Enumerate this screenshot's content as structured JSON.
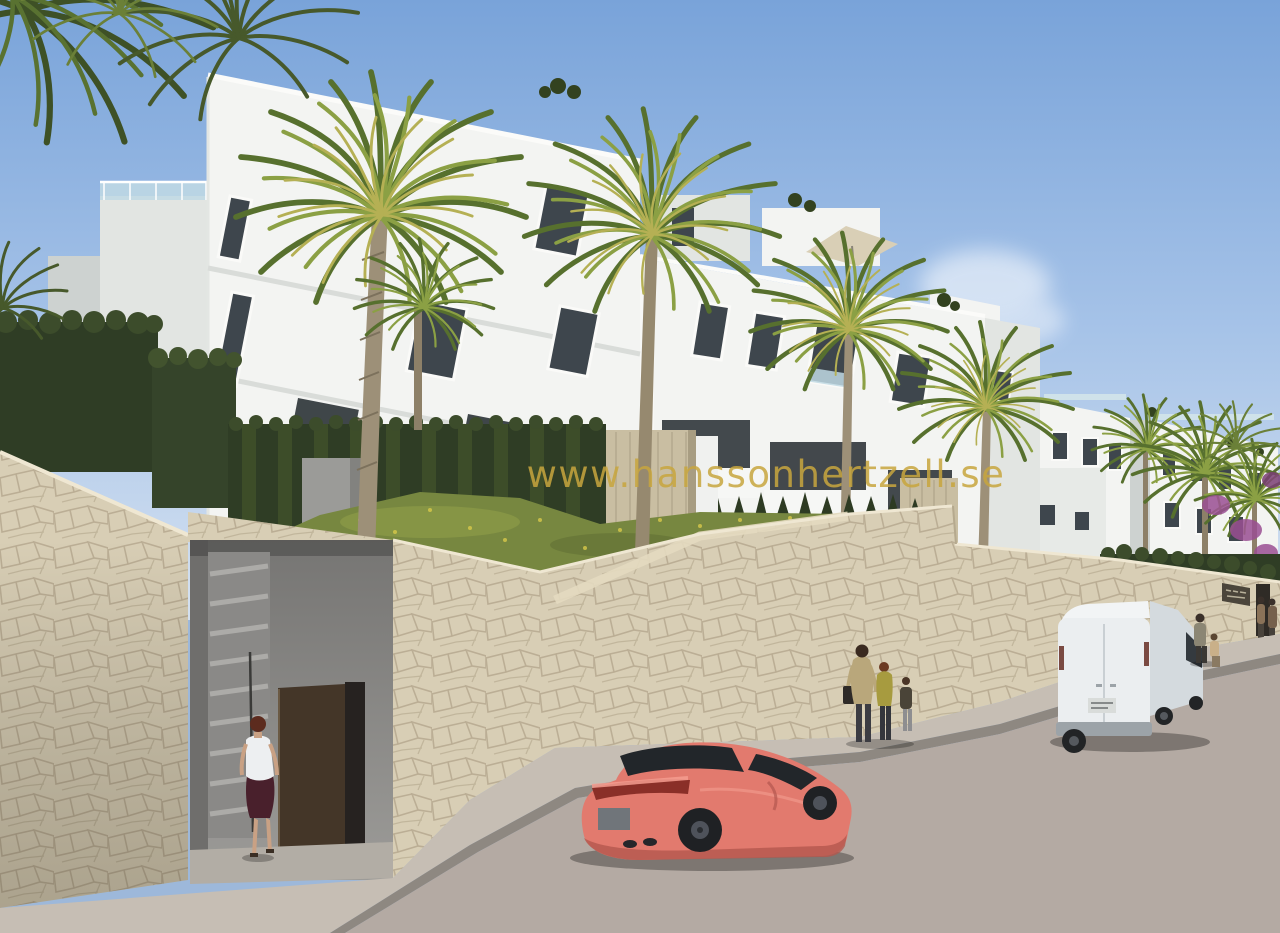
{
  "watermark": {
    "text": "www.hanssonhertzell.se",
    "color": "#C8A63E"
  },
  "scene": {
    "description": "architectural render of a white new-build apartment complex with palm trees behind a cream stone retaining wall, street below with parked coral sports coupe, white panel van and pedestrians",
    "sky": {
      "top": "#79A3D9",
      "mid": "#A6C3E8",
      "horizon": "#D3E0F0",
      "cloud": "#FFFFFF"
    },
    "buildings": {
      "sunlit": "#F3F4F2",
      "shaded": "#E2E5E2",
      "deep_shade": "#CDD2D0",
      "window_glass": "#3E464D",
      "window_frame": "#FAFAF8",
      "railing_glass": "#BFD9E4",
      "recess_shadow": "#30363B"
    },
    "vegetation": {
      "hedge_dark": "#2F3D25",
      "hedge_mid": "#47582C",
      "palm_green": "#57702E",
      "palm_light": "#8BA044",
      "palm_yellow": "#B5B054",
      "grass": "#778740",
      "grass_light": "#9AA64C",
      "flower_yellow": "#D8C94A",
      "trunk": "#9D9078",
      "trunk_dark": "#7C715C",
      "bougainvillea": "#9A4F93"
    },
    "stone": {
      "wall": "#D8CEB5",
      "joints": "#AFA287",
      "cap": "#EFE7D2",
      "pillar": "#C9BEA2",
      "sunlit_band": "#E4DAC0"
    },
    "street": {
      "sidewalk": "#C6BEB4",
      "curb": "#8E8881",
      "road": "#B4AAA3"
    },
    "entry": {
      "concrete": "#949391",
      "stairs": "#ACABA8",
      "door": "#443628",
      "gap": "#262220",
      "threshold": "#B2ADA5"
    },
    "vehicles": {
      "car": {
        "type": "sports-coupe",
        "body": "#E27A6E",
        "highlight": "#F49C8F",
        "shadow": "#B4574E",
        "glass": "#22262A",
        "wheel": "#1F2124",
        "rim": "#4E525A",
        "taillight": "#8A2F28",
        "plate": "#70757A"
      },
      "van": {
        "type": "panel-van",
        "body": "#EBEEF0",
        "side": "#D4DADE",
        "roof": "#F2F4F5",
        "bumper": "#9CA3A8",
        "glass": "#343A3F",
        "wheel": "#222426",
        "taillight": "#7A4A42",
        "plate": "#D9DCDA"
      }
    },
    "sign": {
      "panel": "#4B453B",
      "text_hint": "#B7B09A"
    },
    "parasol": "#D9CFB6"
  },
  "figures": {
    "woman_at_gate": {
      "top": "#EDEFF1",
      "skirt": "#49202C",
      "skin": "#C9A184",
      "hair": "#5C2B1E"
    },
    "mother": {
      "jacket": "#B9A77B",
      "pants": "#3C3C42",
      "bag": "#2E2A27",
      "hair": "#3A2A20"
    },
    "child_1": {
      "top": "#A79B3F",
      "pants": "#34363C"
    },
    "child_2": {
      "top": "#4A4438",
      "pants": "#8E8E90"
    },
    "walker_adult": {
      "top": "#8B8674",
      "pants": "#3B3834"
    },
    "walker_child": {
      "top": "#C9B089"
    },
    "right_pair": {
      "tone": "#8A7258"
    }
  }
}
